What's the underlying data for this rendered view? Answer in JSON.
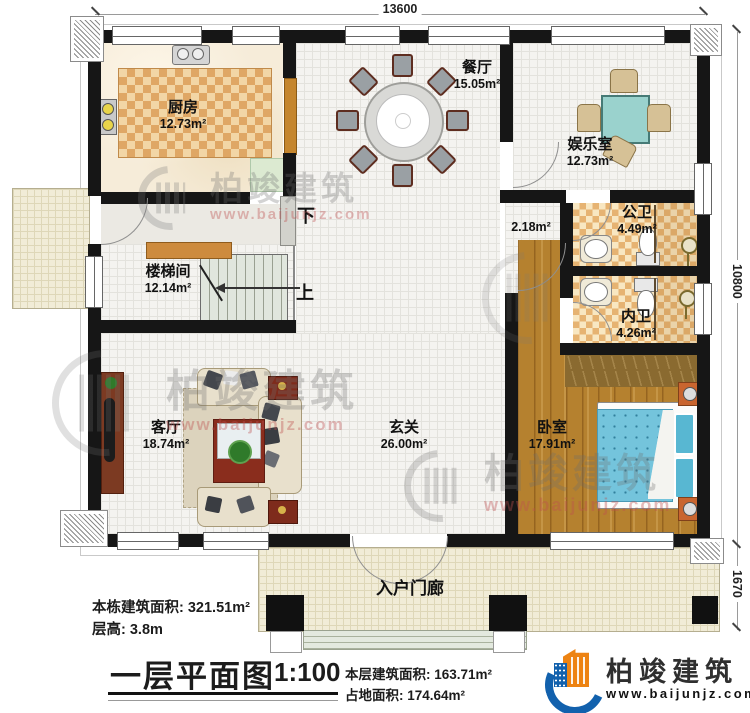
{
  "dimensions": {
    "width": "13600",
    "height": "10800",
    "porch_depth": "1670"
  },
  "rooms": {
    "kitchen": {
      "name": "厨房",
      "area": "12.73m²"
    },
    "dining": {
      "name": "餐厅",
      "area": "15.05m²"
    },
    "entertainment": {
      "name": "娱乐室",
      "area": "12.73m²"
    },
    "public_bath": {
      "name": "公卫",
      "area": "4.49m²"
    },
    "private_bath": {
      "name": "内卫",
      "area": "4.26m²"
    },
    "stairwell": {
      "name": "楼梯间",
      "area": "12.14m²"
    },
    "living": {
      "name": "客厅",
      "area": "18.74m²"
    },
    "foyer": {
      "name": "玄关",
      "area": "26.00m²"
    },
    "bedroom": {
      "name": "卧室",
      "area": "17.91m²"
    },
    "porch": {
      "name": "入户门廊"
    },
    "vestibule": {
      "area": "2.18m²"
    }
  },
  "stairs": {
    "up": "上",
    "down": "下"
  },
  "annotations": {
    "building_total_area": "本栋建筑面积: 321.51m²",
    "floor_height": "层高: 3.8m",
    "title": "一层平面图",
    "scale": "1:100",
    "floor_area": "本层建筑面积: 163.71m²",
    "footprint_area": "占地面积: 174.64m²"
  },
  "brand": {
    "name": "柏竣建筑",
    "url": "www.baijunjz.com"
  },
  "watermark": {
    "name": "柏竣建筑",
    "url": "www.baijunjz.com"
  },
  "colors": {
    "wall": "#161616",
    "kitchen_tile": "#dfa765",
    "bath_tile": "#e6b372",
    "wood_floor": "#b5812f",
    "bed_blue": "#74c4dc",
    "game_table_teal": "#9ad2cd",
    "brand_blue": "#1261ad",
    "brand_orange": "#ed8312"
  }
}
